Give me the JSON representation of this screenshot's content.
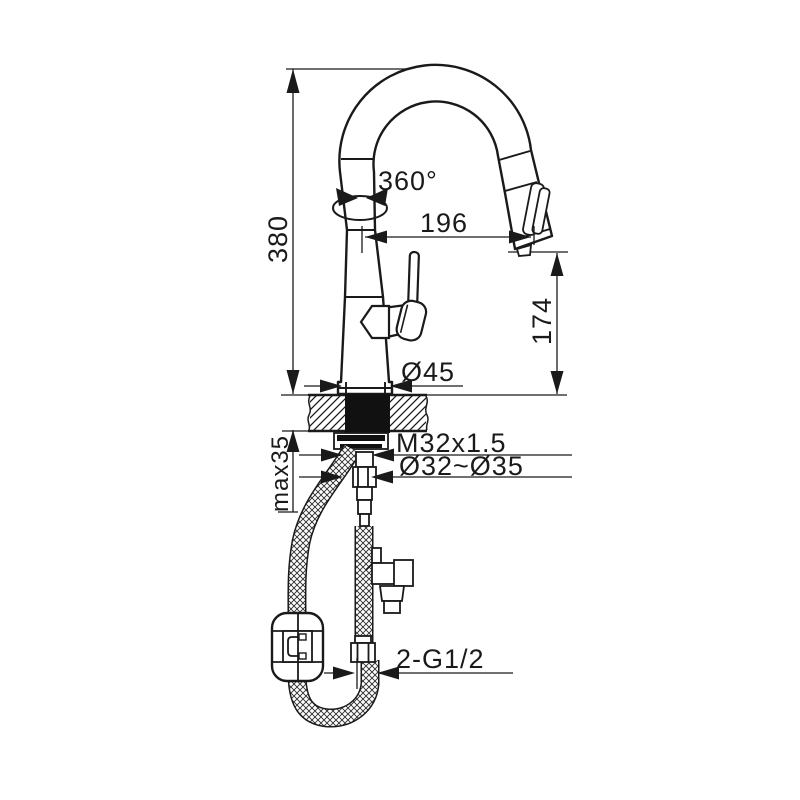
{
  "drawing": {
    "subject": "kitchen-faucet-installation-diagram",
    "line_color": "#1a1a1a",
    "background": "#ffffff",
    "dimensions": {
      "total_height": "380",
      "rotation": "360°",
      "spout_reach": "196",
      "spout_height": "174",
      "base_diameter": "Ø45",
      "mounting_thread": "M32x1.5",
      "hole_diameter": "Ø32~Ø35",
      "max_deck_thickness": "max35",
      "supply_connections": "2-G1/2"
    }
  }
}
